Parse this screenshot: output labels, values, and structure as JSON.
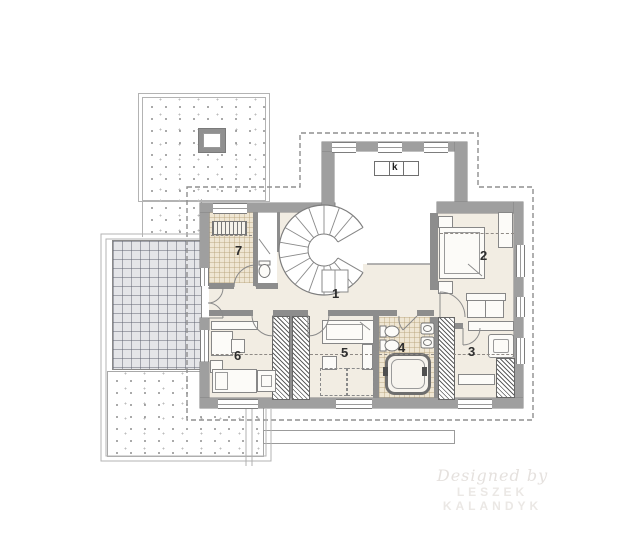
{
  "floor_plan": {
    "room_labels": [
      "1",
      "2",
      "3",
      "4",
      "5",
      "6",
      "7"
    ],
    "fireplace_label": "k",
    "watermark": {
      "line1": "Designed by",
      "line2": "LESZEK KALANDYK"
    },
    "colors": {
      "exterior_wall": "#9f9f9f",
      "interior_wall": "#8d8d8d",
      "room_floor": "#f2ede3",
      "tiled_floor": "#efe6d3",
      "terrace_tiles": "#e4e5e8",
      "roof_dash_line": "#8f8f8f",
      "watermark_text": "#e8e4e1"
    }
  }
}
